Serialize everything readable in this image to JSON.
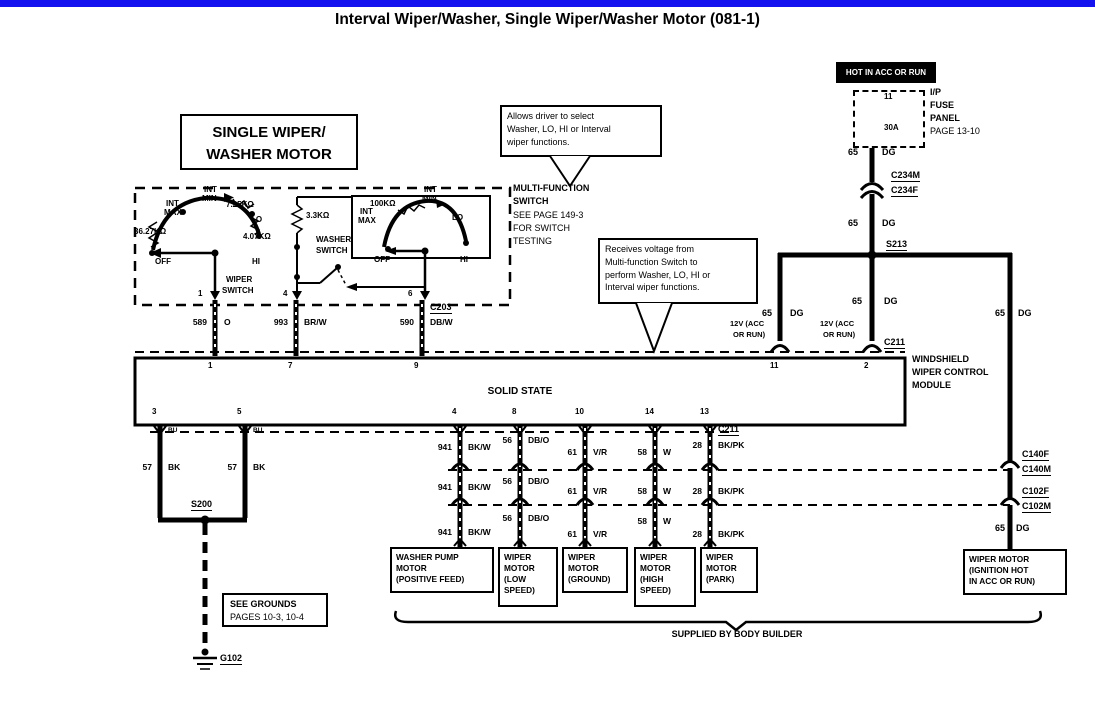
{
  "title": "Interval Wiper/Washer, Single Wiper/Washer Motor (081-1)",
  "motor_title": {
    "l1": "SINGLE WIPER/",
    "l2": "WASHER MOTOR"
  },
  "callout_select": {
    "l1": "Allows driver to select",
    "l2": "Washer, LO, HI or Interval",
    "l3": "wiper functions."
  },
  "callout_receive": {
    "l1": "Receives voltage from",
    "l2": "Multi-function Switch to",
    "l3": "perform Washer, LO, HI or",
    "l4": "Interval wiper functions."
  },
  "power": {
    "hot": "HOT IN ACC OR RUN",
    "fuse_pin": "11",
    "fuse_rating": "30A",
    "panel_l1": "I/P",
    "panel_l2": "FUSE",
    "panel_l3": "PANEL",
    "panel_l4": "PAGE 13-10",
    "c234m": "C234M",
    "c234f": "C234F",
    "s213": "S213",
    "v12_l1": "12V (ACC",
    "v12_l2": "OR RUN)"
  },
  "mfs": {
    "name_l1": "MULTI-FUNCTION",
    "name_l2": "SWITCH",
    "note_l1": "SEE PAGE 149-3",
    "note_l2": "FOR SWITCH",
    "note_l3": "TESTING",
    "int": "INT",
    "max": "MAX",
    "min": "MIN",
    "lo": "LO",
    "hi": "HI",
    "off": "OFF",
    "r36": "36.27KΩ",
    "r7": "7.25KΩ",
    "r4": "4.07KΩ",
    "r3": "3.3KΩ",
    "r100": "100KΩ",
    "wiper_l1": "WIPER",
    "wiper_l2": "SWITCH",
    "washer_l1": "WASHER",
    "washer_l2": "SWITCH",
    "pin1": "1",
    "pin4": "4",
    "pin6": "6"
  },
  "wires": {
    "g65": "65",
    "dg": "DG",
    "n589": "589",
    "o": "O",
    "n993": "993",
    "brw": "BR/W",
    "n590": "590",
    "dbw": "DB/W",
    "c203": "C203",
    "n57": "57",
    "bk": "BK",
    "bu": "BU",
    "n941": "941",
    "bkw": "BK/W",
    "n56": "56",
    "dbo": "DB/O",
    "n61": "61",
    "vr": "V/R",
    "n58": "58",
    "w": "W",
    "n28": "28",
    "bkpk": "BK/PK",
    "c211": "C211",
    "c140f": "C140F",
    "c140m": "C140M",
    "c102f": "C102F",
    "c102m": "C102M"
  },
  "module": {
    "solid_state": "SOLID STATE",
    "name_l1": "WINDSHIELD",
    "name_l2": "WIPER CONTROL",
    "name_l3": "MODULE",
    "tp1": "1",
    "tp7": "7",
    "tp9": "9",
    "tp11": "11",
    "tp2": "2",
    "bp3": "3",
    "bp5": "5",
    "bp4": "4",
    "bp8": "8",
    "bp10": "10",
    "bp14": "14",
    "bp13": "13"
  },
  "ground": {
    "s200": "S200",
    "note_l1": "SEE GROUNDS",
    "note_l2": "PAGES 10-3, 10-4",
    "g102": "G102"
  },
  "motors": {
    "washer_pump": {
      "l1": "WASHER PUMP",
      "l2": "MOTOR",
      "l3": "(POSITIVE FEED)"
    },
    "low": {
      "l1": "WIPER",
      "l2": "MOTOR",
      "l3": "(LOW",
      "l4": "SPEED)"
    },
    "gnd": {
      "l1": "WIPER",
      "l2": "MOTOR",
      "l3": "(GROUND)"
    },
    "high": {
      "l1": "WIPER",
      "l2": "MOTOR",
      "l3": "(HIGH",
      "l4": "SPEED)"
    },
    "park": {
      "l1": "WIPER",
      "l2": "MOTOR",
      "l3": "(PARK)"
    },
    "main": {
      "l1": "WIPER MOTOR",
      "l2": "(IGNITION HOT",
      "l3": "IN ACC OR RUN)"
    }
  },
  "footer": {
    "supplied": "SUPPLIED BY BODY BUILDER"
  }
}
